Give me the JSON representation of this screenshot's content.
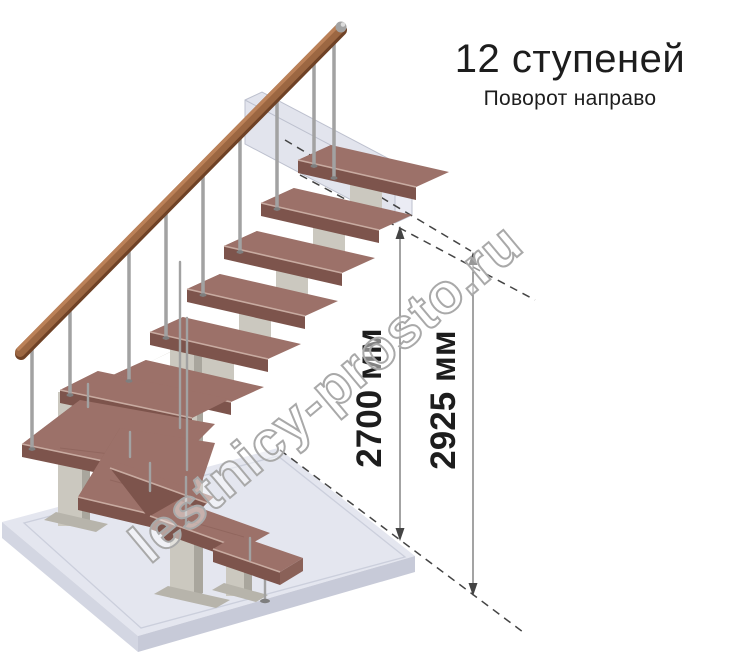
{
  "header": {
    "title": "12 ступеней",
    "subtitle": "Поворот направо"
  },
  "dimensions": [
    {
      "label": "2700 мм"
    },
    {
      "label": "2925 мм"
    }
  ],
  "watermark": {
    "text": "lestnicy-prosto.ru"
  },
  "palette": {
    "background": "#ffffff",
    "text_color": "#1d1d1d",
    "tread_top": "#9c7169",
    "tread_front": "#7d544c",
    "tread_side": "#8a6158",
    "tread_edge": "#c8aba1",
    "handrail_dark": "#6f4226",
    "handrail_mid": "#9c6742",
    "handrail_light": "#bb8158",
    "steel": "#a2a2a2",
    "support": "#cbc8bf",
    "support_dark": "#a9a69d",
    "support_base": "#b7b4ab",
    "floor_top": "#e4e6ef",
    "floor_left": "#d3d6e2",
    "floor_right": "#c7cad8",
    "beam_fill": "#dfe2ec",
    "beam_edge": "#b6bac9",
    "dim": "#666666",
    "dash": "#444444",
    "watermark": "#a9a9a9"
  }
}
